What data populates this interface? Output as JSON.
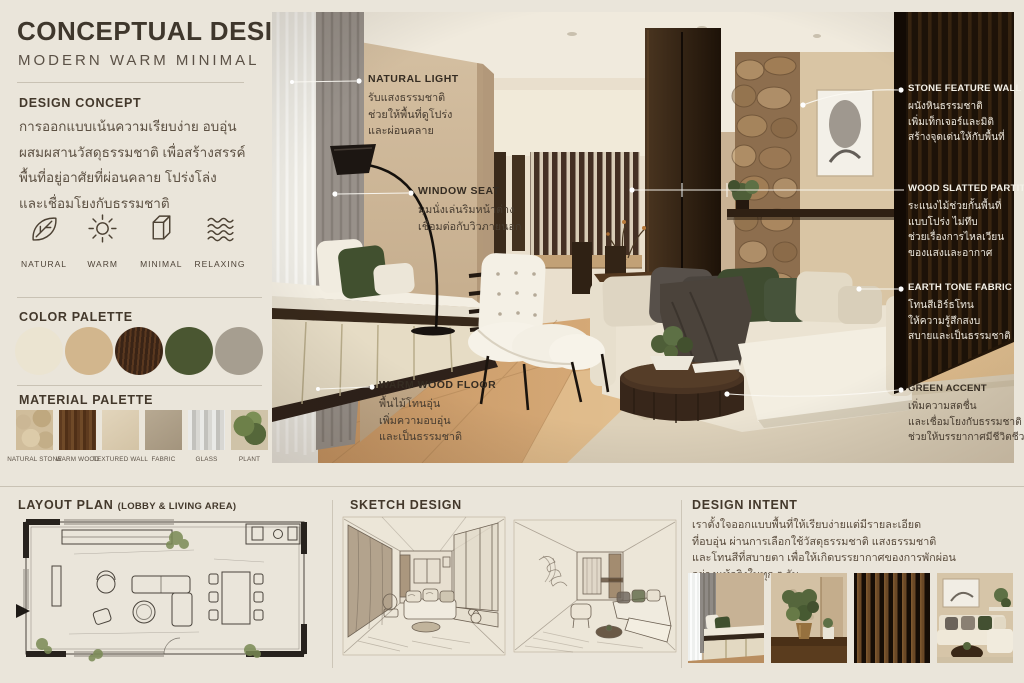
{
  "header": {
    "title": "CONCEPTUAL DESIGN",
    "subtitle": "MODERN WARM MINIMAL"
  },
  "design_concept": {
    "heading": "DESIGN CONCEPT",
    "lines": [
      "การออกแบบเน้นความเรียบง่าย อบอุ่น",
      "ผสมผสานวัสดุธรรมชาติ เพื่อสร้างสรรค์",
      "พื้นที่อยู่อาศัยที่ผ่อนคลาย โปร่งโล่ง",
      "และเชื่อมโยงกับธรรมชาติ"
    ]
  },
  "keywords": {
    "items": [
      {
        "label": "NATURAL",
        "icon": "leaf-icon"
      },
      {
        "label": "WARM",
        "icon": "sun-icon"
      },
      {
        "label": "MINIMAL",
        "icon": "box-icon"
      },
      {
        "label": "RELAXING",
        "icon": "waves-icon"
      }
    ]
  },
  "color_palette": {
    "heading": "COLOR PALETTE",
    "colors": [
      {
        "name": "cream",
        "hex": "#ebe4d1"
      },
      {
        "name": "sand",
        "hex": "#d2b68d"
      },
      {
        "name": "dark-wood-brown",
        "hex": "#3a2416"
      },
      {
        "name": "olive-green",
        "hex": "#4a5631"
      },
      {
        "name": "warm-grey",
        "hex": "#a69e90"
      }
    ]
  },
  "material_palette": {
    "heading": "MATERIAL PALETTE",
    "materials": [
      {
        "label": "NATURAL STONE"
      },
      {
        "label": "WARM WOOD"
      },
      {
        "label": "TEXTURED WALL"
      },
      {
        "label": "FABRIC"
      },
      {
        "label": "GLASS"
      },
      {
        "label": "PLANT"
      }
    ]
  },
  "annotations": {
    "natural_light": {
      "label": "NATURAL LIGHT",
      "lines": [
        "รับแสงธรรมชาติ",
        "ช่วยให้พื้นที่ดูโปร่ง",
        "และผ่อนคลาย"
      ]
    },
    "window_seat": {
      "label": "WINDOW SEAT",
      "lines": [
        "มุมนั่งเล่นริมหน้าต่าง",
        "เชื่อมต่อกับวิวภายนอก"
      ]
    },
    "warm_wood_floor": {
      "label": "WARM WOOD FLOOR",
      "lines": [
        "พื้นไม้โทนอุ่น",
        "เพิ่มความอบอุ่น",
        "และเป็นธรรมชาติ"
      ]
    },
    "stone_feature_wall": {
      "label": "STONE FEATURE WALL",
      "lines": [
        "ผนังหินธรรมชาติ",
        "เพิ่มเท็กเจอร์และมิติ",
        "สร้างจุดเด่นให้กับพื้นที่"
      ]
    },
    "wood_slatted_partition": {
      "label": "WOOD SLATTED PARTITION",
      "lines": [
        "ระแนงไม้ช่วยกั้นพื้นที่",
        "แบบโปร่ง ไม่ทึบ",
        "ช่วยเรื่องการไหลเวียน",
        "ของแสงและอากาศ"
      ]
    },
    "earth_tone_fabric": {
      "label": "EARTH TONE FABRIC",
      "lines": [
        "โทนสีเอิร์ธโทน",
        "ให้ความรู้สึกสงบ",
        "สบายและเป็นธรรมชาติ"
      ]
    },
    "green_accent": {
      "label": "GREEN ACCENT",
      "lines": [
        "เพิ่มความสดชื่น",
        "และเชื่อมโยงกับธรรมชาติ",
        "ช่วยให้บรรยากาศมีชีวิตชีวา"
      ]
    }
  },
  "layout_plan": {
    "heading": "LAYOUT PLAN",
    "subheading": "(LOBBY & LIVING AREA)"
  },
  "sketch_design": {
    "heading": "SKETCH DESIGN"
  },
  "design_intent": {
    "heading": "DESIGN INTENT",
    "lines": [
      "เราตั้งใจออกแบบพื้นที่ให้เรียบง่ายแต่มีรายละเอียด",
      "ที่อบอุ่น ผ่านการเลือกใช้วัสดุธรรมชาติ แสงธรรมชาติ",
      "และโทนสีที่สบายตา เพื่อให้เกิดบรรยากาศของการพักผ่อน",
      "อย่างแท้จริงในทุก ๆ วัน"
    ],
    "thumbnails": [
      {
        "name": "window-seat"
      },
      {
        "name": "plant-corner"
      },
      {
        "name": "wood-slat-wall"
      },
      {
        "name": "sofa-corner"
      }
    ]
  }
}
